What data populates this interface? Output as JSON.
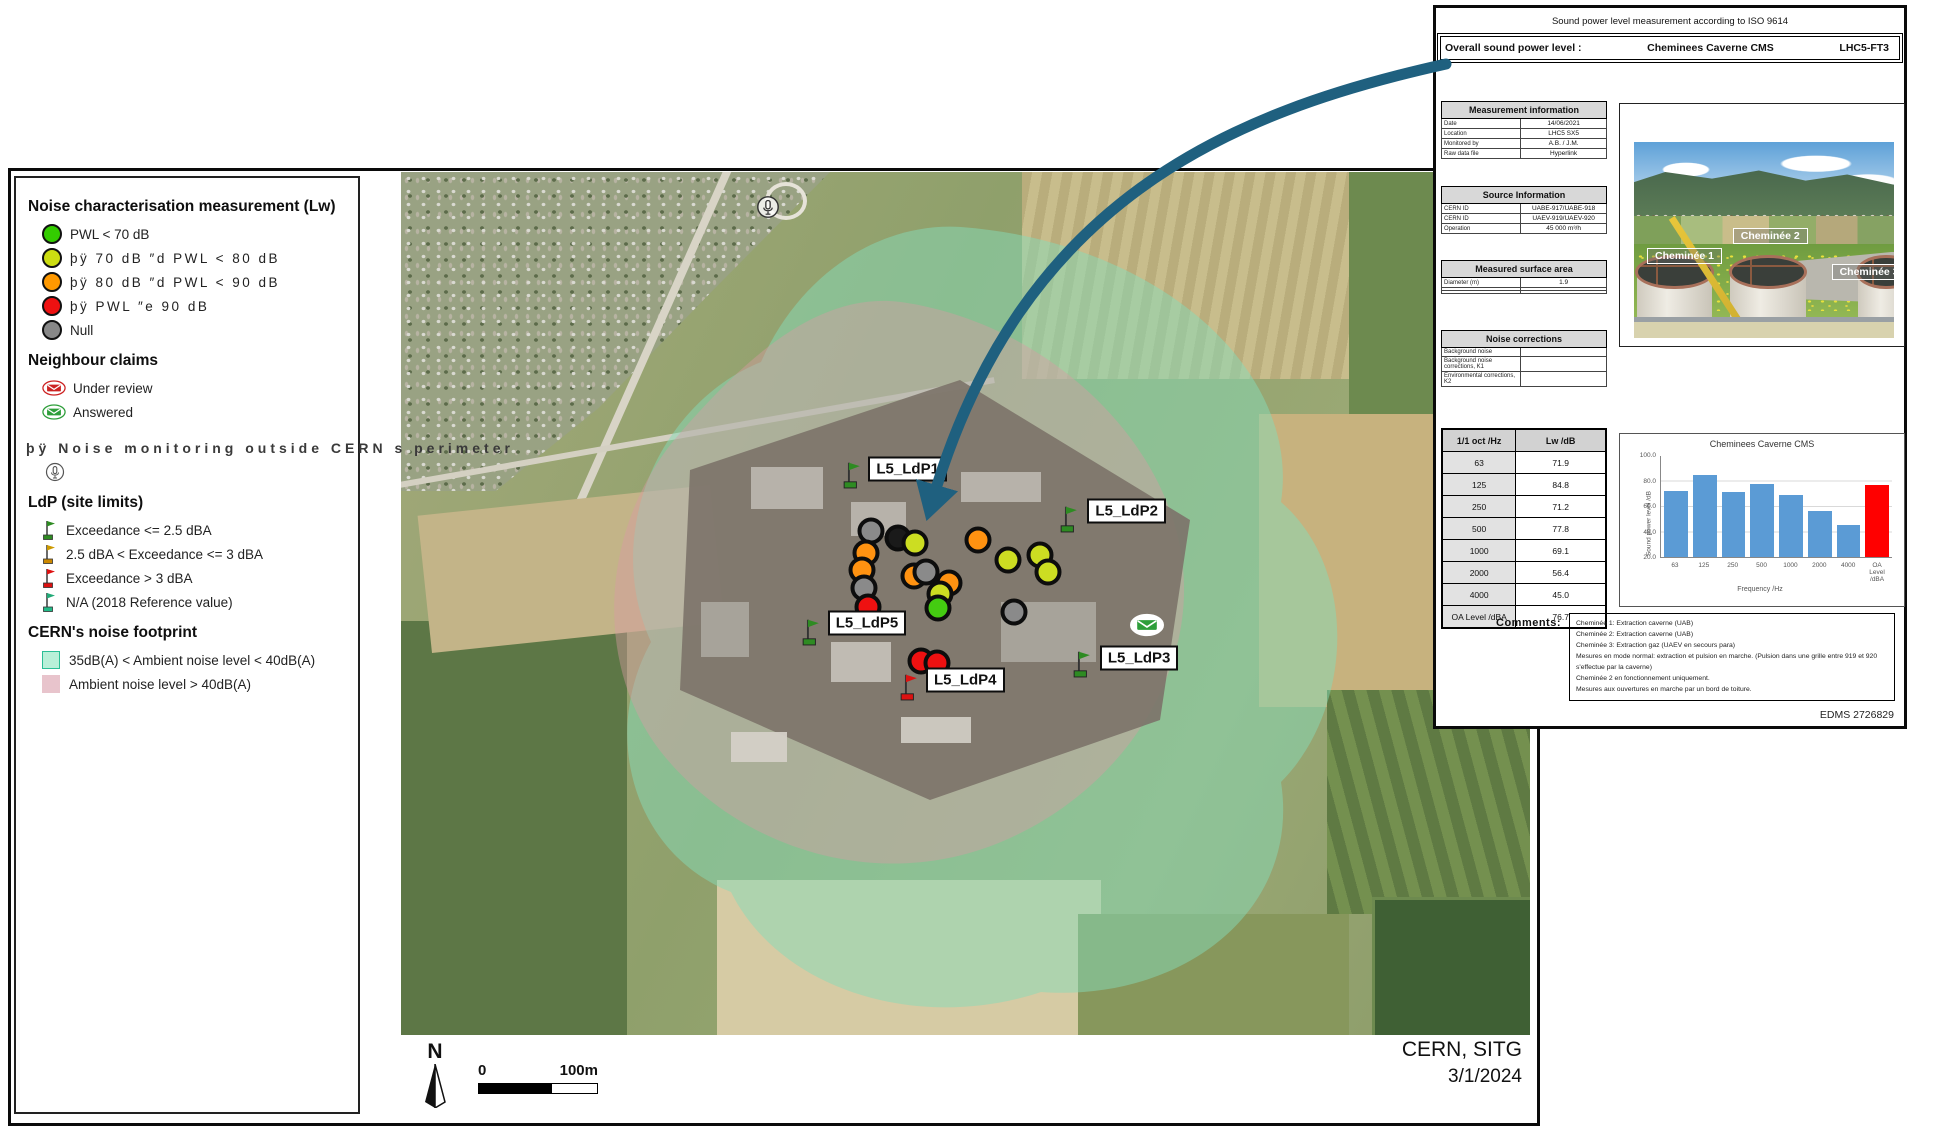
{
  "legend": {
    "sections": [
      {
        "title": "Noise characterisation measurement (Lw)",
        "items": [
          {
            "icon": "circle",
            "color": "#33cc00",
            "label": "PWL < 70 dB",
            "spaced": false
          },
          {
            "icon": "circle",
            "color": "#ccdd11",
            "label": "þÿ 70 dB ″d PWL < 80 dB",
            "spaced": true
          },
          {
            "icon": "circle",
            "color": "#ff9900",
            "label": "þÿ 80 dB ″d PWL < 90 dB",
            "spaced": true
          },
          {
            "icon": "circle",
            "color": "#ee1111",
            "label": "þÿ PWL ″e 90 dB",
            "spaced": true
          },
          {
            "icon": "circle",
            "color": "#888888",
            "label": "Null",
            "spaced": false
          }
        ]
      },
      {
        "title": "Neighbour claims",
        "items": [
          {
            "icon": "envelope",
            "color": "#cc2222",
            "label": "Under review"
          },
          {
            "icon": "envelope",
            "color": "#2e9e3a",
            "label": "Answered"
          }
        ]
      },
      {
        "title": null,
        "overflow_line": "þÿ Noise monitoring outside CERN s perimeter",
        "items": [
          {
            "icon": "mic",
            "color": "#555555",
            "label": ""
          }
        ]
      },
      {
        "title": "LdP (site limits)",
        "items": [
          {
            "icon": "flag",
            "color": "#2e8b22",
            "base": "#2e8b22",
            "label": "Exceedance <= 2.5 dBA"
          },
          {
            "icon": "flag",
            "color": "#cc9900",
            "base": "#cc8800",
            "label": "2.5 dBA < Exceedance <= 3 dBA"
          },
          {
            "icon": "flag",
            "color": "#dd1111",
            "base": "#dd1111",
            "label": "Exceedance > 3 dBA"
          },
          {
            "icon": "flag",
            "color": "#22aa77",
            "base": "#22bb88",
            "label": "N/A (2018 Reference value)"
          }
        ]
      },
      {
        "title": "CERN's noise footprint",
        "items": [
          {
            "icon": "swatch",
            "color": "#b8f0d8",
            "border": "#2bbf96",
            "label": "35dB(A) < Ambient noise level < 40dB(A)"
          },
          {
            "icon": "swatch",
            "color": "#e8c4cc",
            "border": "#e8c4cc",
            "label": "Ambient noise level > 40dB(A)"
          }
        ]
      }
    ]
  },
  "map": {
    "flags": [
      {
        "label": "L5_LdP1",
        "color": "#2e8b22",
        "x": 40.0,
        "y": 36.9,
        "lx": 41.4,
        "ly": 34.4
      },
      {
        "label": "L5_LdP2",
        "color": "#2e8b22",
        "x": 59.3,
        "y": 41.9,
        "lx": 60.8,
        "ly": 39.3
      },
      {
        "label": "L5_LdP3",
        "color": "#2e8b22",
        "x": 60.4,
        "y": 58.7,
        "lx": 61.9,
        "ly": 56.3
      },
      {
        "label": "L5_LdP4",
        "color": "#dd1111",
        "x": 45.1,
        "y": 61.4,
        "lx": 46.5,
        "ly": 58.9
      },
      {
        "label": "L5_LdP5",
        "color": "#2e8b22",
        "x": 36.4,
        "y": 55.0,
        "lx": 37.8,
        "ly": 52.3
      }
    ],
    "points": [
      {
        "c": "gray",
        "x": 41.6,
        "y": 41.6
      },
      {
        "c": "black",
        "x": 44.0,
        "y": 42.4
      },
      {
        "c": "yellow",
        "x": 45.5,
        "y": 43.0
      },
      {
        "c": "orange",
        "x": 51.1,
        "y": 42.6
      },
      {
        "c": "yellow",
        "x": 53.8,
        "y": 45.0
      },
      {
        "c": "yellow",
        "x": 56.6,
        "y": 44.4
      },
      {
        "c": "yellow",
        "x": 57.3,
        "y": 46.4
      },
      {
        "c": "orange",
        "x": 41.2,
        "y": 44.2
      },
      {
        "c": "orange",
        "x": 40.8,
        "y": 46.1
      },
      {
        "c": "orange",
        "x": 45.4,
        "y": 46.8
      },
      {
        "c": "gray",
        "x": 46.5,
        "y": 46.4
      },
      {
        "c": "orange",
        "x": 48.5,
        "y": 47.6
      },
      {
        "c": "gray",
        "x": 41.0,
        "y": 48.2
      },
      {
        "c": "yellow",
        "x": 47.7,
        "y": 48.9
      },
      {
        "c": "red",
        "x": 41.4,
        "y": 50.4
      },
      {
        "c": "green",
        "x": 47.6,
        "y": 50.5
      },
      {
        "c": "gray",
        "x": 54.3,
        "y": 51.0
      },
      {
        "c": "red",
        "x": 46.1,
        "y": 56.7
      },
      {
        "c": "red",
        "x": 47.5,
        "y": 56.9
      }
    ],
    "envelope": {
      "x": 66.1,
      "y": 52.5
    },
    "mic": {
      "x": 32.5,
      "y": 4.0
    },
    "credit_line1": "CERN, SITG",
    "credit_line2": "3/1/2024",
    "north_label": "N",
    "scale_start": "0",
    "scale_end": "100m"
  },
  "panel": {
    "title": "Sound power level measurement according to ISO 9614",
    "overall_label": "Overall sound power level :",
    "overall_name": "Cheminees Caverne CMS",
    "overall_code": "LHC5-FT3",
    "tables": [
      {
        "title": "Measurement information",
        "top": 93,
        "rows": [
          [
            "Date",
            "14/06/2021"
          ],
          [
            "Location",
            "LHC5 SX5"
          ],
          [
            "Monitored by",
            "A.B. / J.M."
          ],
          [
            "Raw data file",
            "Hyperlink"
          ]
        ]
      },
      {
        "title": "Source Information",
        "top": 178,
        "rows": [
          [
            "CERN ID",
            "UABE-917/UABE-918"
          ],
          [
            "CERN ID",
            "UAEV-919/UAEV-920"
          ],
          [
            "Operation",
            "45 000 m³/h"
          ]
        ]
      },
      {
        "title": "Measured surface area",
        "top": 252,
        "rows": [
          [
            "Diameter (m)",
            "1.9"
          ],
          [
            "",
            ""
          ],
          [
            "",
            ""
          ]
        ]
      },
      {
        "title": "Noise corrections",
        "top": 322,
        "rows": [
          [
            "Background noise",
            ""
          ],
          [
            "Background noise corrections, K1",
            ""
          ],
          [
            "Environmental corrections, K2",
            ""
          ]
        ]
      }
    ],
    "oct_table": {
      "headers": [
        "1/1 oct /Hz",
        "Lw /dB"
      ],
      "rows": [
        [
          "63",
          "71.9"
        ],
        [
          "125",
          "84.8"
        ],
        [
          "250",
          "71.2"
        ],
        [
          "500",
          "77.8"
        ],
        [
          "1000",
          "69.1"
        ],
        [
          "2000",
          "56.4"
        ],
        [
          "4000",
          "45.0"
        ],
        [
          "OA Level /dBA",
          "76.7"
        ]
      ]
    },
    "comments_label": "Comments:",
    "comments": [
      "Cheminée 1: Extraction caverne (UAB)",
      "Cheminée 2: Extraction caverne (UAB)",
      "Cheminée 3: Extraction gaz (UAEV en secours para)",
      "Mesures en mode normal: extraction et pulsion en marche. (Pulsion dans une grille entre 919 et 920",
      "s'effectue par la caverne)",
      "Cheminée 2 en fonctionnement uniquement.",
      "Mesures aux ouvertures en marche par un bord de toiture."
    ],
    "edms": "EDMS 2726829",
    "photo_labels": [
      "Cheminée 1",
      "Cheminée 2",
      "Cheminée 3"
    ]
  },
  "chart_data": {
    "type": "bar",
    "title": "Cheminees Caverne CMS",
    "categories": [
      "63",
      "125",
      "250",
      "500",
      "1000",
      "2000",
      "4000",
      "OA Level /dBA"
    ],
    "values": [
      71.9,
      84.8,
      71.2,
      77.8,
      69.1,
      56.4,
      45.0,
      76.7
    ],
    "bar_colors": [
      "#5b9bd5",
      "#5b9bd5",
      "#5b9bd5",
      "#5b9bd5",
      "#5b9bd5",
      "#5b9bd5",
      "#5b9bd5",
      "#ff0000"
    ],
    "xlabel": "Frequency /Hz",
    "ylabel": "Sound power level /dB",
    "ylim": [
      20,
      100
    ],
    "yticks": [
      "100.0",
      "80.0",
      "60.0",
      "40.0",
      "20.0"
    ],
    "grid": true,
    "legend_position": "none"
  },
  "colors": {
    "footprint_teal": "#86dcb8",
    "footprint_pink": "#d89aa4",
    "arrow": "#1f607f"
  }
}
